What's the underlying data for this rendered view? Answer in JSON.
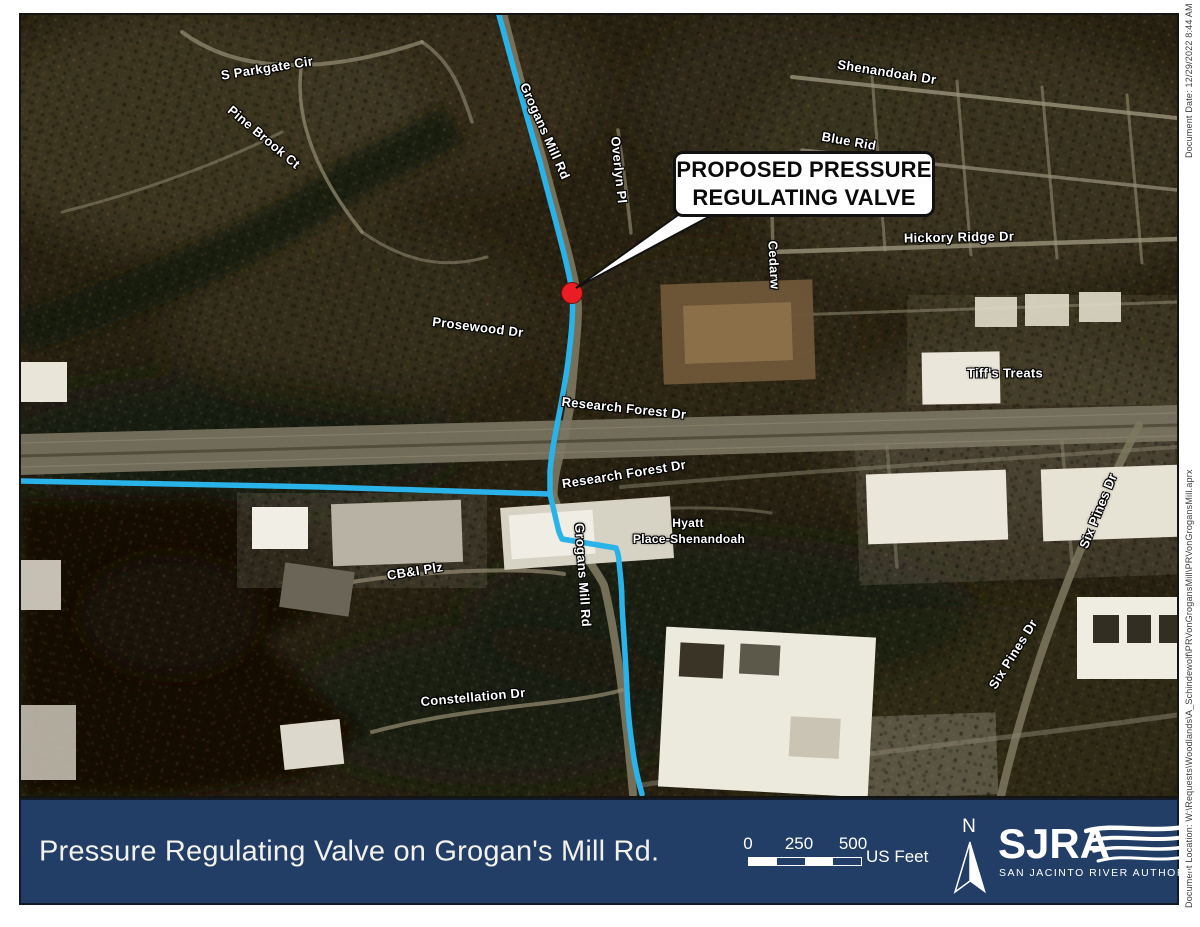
{
  "map": {
    "callout": {
      "line1": "PROPOSED PRESSURE",
      "line2": "REGULATING VALVE"
    },
    "marker_color": "#ea1c24",
    "route_color": "#2ab3e8",
    "labels": [
      {
        "id": "s-parkgate-cir",
        "text": "S Parkgate Cir"
      },
      {
        "id": "pine-brook-ct",
        "text": "Pine Brook Ct"
      },
      {
        "id": "grogans-mill-rd-upper",
        "text": "Grogans Mill Rd"
      },
      {
        "id": "overlyn-pl",
        "text": "Overlyn Pl"
      },
      {
        "id": "shenandoah-dr",
        "text": "Shenandoah Dr"
      },
      {
        "id": "blue-rid",
        "text": "Blue Rid"
      },
      {
        "id": "hickory-ridge-dr",
        "text": "Hickory Ridge Dr"
      },
      {
        "id": "cedarw",
        "text": "Cedarw"
      },
      {
        "id": "prosewood-dr",
        "text": "Prosewood Dr"
      },
      {
        "id": "research-forest-dr-west",
        "text": "Research Forest Dr"
      },
      {
        "id": "research-forest-dr-east",
        "text": "Research Forest Dr"
      },
      {
        "id": "hyatt-line1",
        "text": "Hyatt"
      },
      {
        "id": "hyatt-line2",
        "text": "Place-Shenandoah"
      },
      {
        "id": "grogans-mill-rd-lower",
        "text": "Grogans Mill Rd"
      },
      {
        "id": "cbi-plz",
        "text": "CB&I Plz"
      },
      {
        "id": "constellation-dr",
        "text": "Constellation Dr"
      },
      {
        "id": "tiffs-treats",
        "text": "Tiff's Treats"
      },
      {
        "id": "six-pines-dr-upper",
        "text": "Six Pines Dr"
      },
      {
        "id": "six-pines-dr-lower",
        "text": "Six Pines Dr"
      }
    ]
  },
  "margin": {
    "document_date": "Document Date: 12/29/2022 8:44 AM",
    "document_location": "Document Location: W:\\Requests\\Woodlands\\A_Schindewolf\\PRVonGrogansMill\\PRVonGrogansMill.aprx"
  },
  "footer": {
    "title": "Pressure Regulating Valve on Grogan's Mill Rd.",
    "bar_color": "#223e66",
    "scale": {
      "ticks": [
        "0",
        "250",
        "500"
      ],
      "unit": "US Feet"
    },
    "north_label": "N",
    "logo": {
      "acronym": "SJRA",
      "name": "SAN JACINTO RIVER AUTHORITY"
    }
  }
}
